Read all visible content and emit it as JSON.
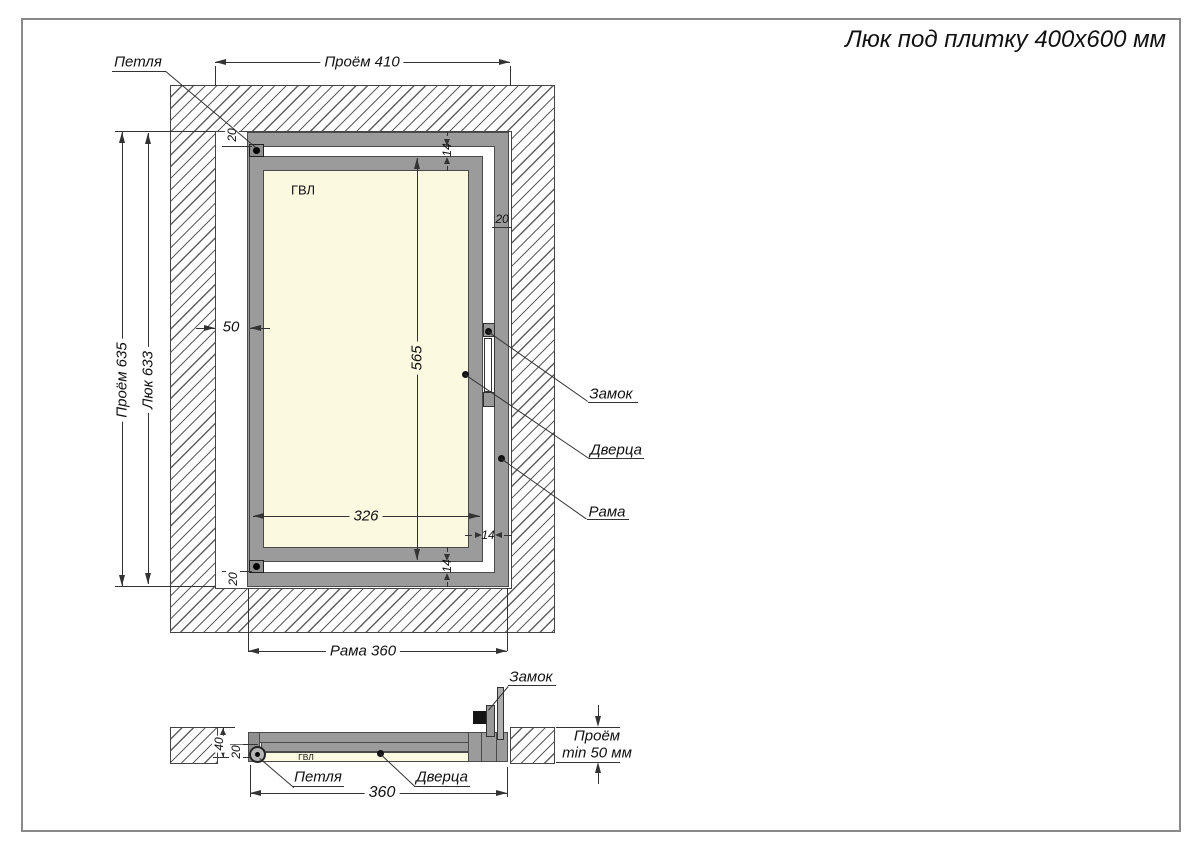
{
  "title": "Люк под плитку 400x600 мм",
  "front": {
    "lbl_hinge": "Петля",
    "lbl_lock": "Замок",
    "lbl_door": "Дверца",
    "lbl_frame": "Рама",
    "lbl_panel": "ГВЛ",
    "dim_opening_w": "Проём 410",
    "dim_opening_h": "Проём 635",
    "dim_hatch_h": "Люк 633",
    "dim_frame_w": "Рама 360",
    "dim_door_h": "565",
    "dim_door_w": "326",
    "dim_offset": "50",
    "dim_gap": "14",
    "dim_20": "20"
  },
  "section": {
    "lbl_lock": "Замок",
    "lbl_hinge": "Петля",
    "lbl_door": "Дверца",
    "lbl_panel": "ГВЛ",
    "dim_width": "360",
    "dim_40": "40",
    "dim_20": "20",
    "dim_depth_line1": "Проём",
    "dim_depth_line2": "min 50 мм"
  },
  "colors": {
    "frame_gray": "#9b9b9b",
    "panel_cream": "#fbf9e0",
    "line": "#333333",
    "hatch_line": "#5f5f5f"
  }
}
